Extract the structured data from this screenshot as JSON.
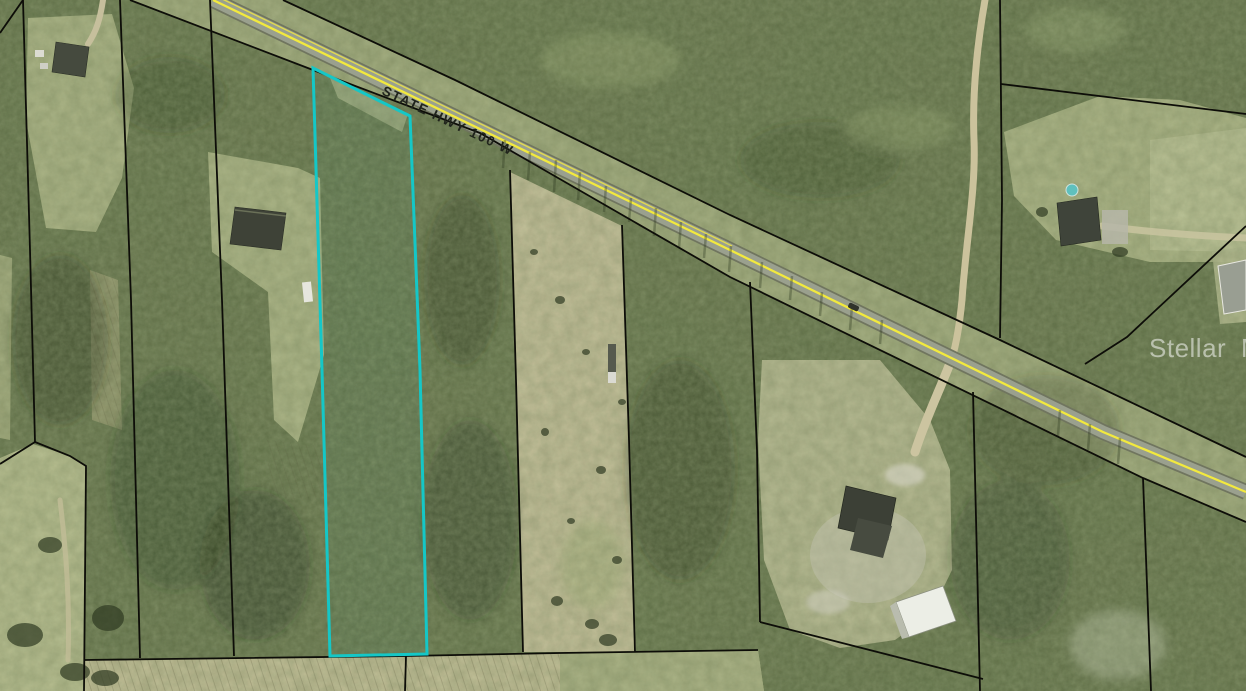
{
  "map": {
    "road": {
      "label": "STATE HWY 100 W",
      "centerline_color": "#f2e93e",
      "pavement_color": "#9aa08e"
    },
    "watermark": {
      "brand": "Stellar",
      "suffix": "MLS",
      "color": "#ffffff"
    },
    "parcel": {
      "highlight_color": "#15c7c7"
    },
    "boundary_color": "#0d0d08",
    "landcover": {
      "forest_base": "#64714a",
      "clearing": "#b2b88a",
      "plowed_field": "#c4be99"
    }
  }
}
